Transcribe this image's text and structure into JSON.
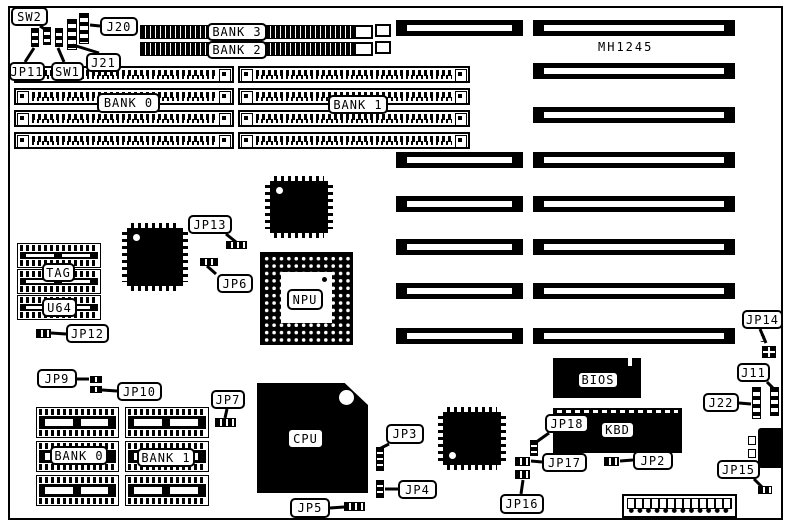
{
  "board": {
    "model": "MH1245",
    "colors": {
      "ink": "#000000",
      "paper": "#ffffff"
    },
    "border": {
      "x": 8,
      "y": 6,
      "w": 775,
      "h": 514
    },
    "callouts": [
      {
        "id": "sw2",
        "label": "SW2",
        "x": 11,
        "y": 7,
        "w": 37,
        "h": 19,
        "leader": [
          [
            40,
            26
          ],
          [
            46,
            30
          ]
        ]
      },
      {
        "id": "j20",
        "label": "J20",
        "x": 100,
        "y": 17,
        "w": 38,
        "h": 19,
        "leader": [
          [
            100,
            26
          ],
          [
            90,
            25
          ]
        ]
      },
      {
        "id": "j21",
        "label": "J21",
        "x": 86,
        "y": 53,
        "w": 35,
        "h": 19,
        "leader": [
          [
            99,
            53
          ],
          [
            73,
            45
          ]
        ]
      },
      {
        "id": "jp11",
        "label": "JP11",
        "x": 9,
        "y": 62,
        "w": 36,
        "h": 19,
        "leader": [
          [
            25,
            62
          ],
          [
            34,
            48
          ]
        ]
      },
      {
        "id": "sw1",
        "label": "SW1",
        "x": 51,
        "y": 62,
        "w": 33,
        "h": 19,
        "leader": [
          [
            64,
            62
          ],
          [
            58,
            48
          ]
        ]
      },
      {
        "id": "bank3",
        "label": "BANK 3",
        "x": 207,
        "y": 23,
        "w": 60,
        "h": 18
      },
      {
        "id": "bank2",
        "label": "BANK 2",
        "x": 207,
        "y": 41,
        "w": 60,
        "h": 18
      },
      {
        "id": "bank0-top",
        "label": "BANK 0",
        "x": 97,
        "y": 93,
        "w": 63,
        "h": 20
      },
      {
        "id": "bank1-top",
        "label": "BANK 1",
        "x": 328,
        "y": 95,
        "w": 60,
        "h": 19
      },
      {
        "id": "jp13",
        "label": "JP13",
        "x": 188,
        "y": 215,
        "w": 44,
        "h": 19,
        "leader": [
          [
            226,
            234
          ],
          [
            236,
            242
          ]
        ]
      },
      {
        "id": "jp6",
        "label": "JP6",
        "x": 217,
        "y": 274,
        "w": 36,
        "h": 19,
        "leader": [
          [
            216,
            274
          ],
          [
            207,
            266
          ]
        ]
      },
      {
        "id": "tag",
        "label": "TAG",
        "x": 42,
        "y": 263,
        "w": 33,
        "h": 19
      },
      {
        "id": "u64",
        "label": "U64",
        "x": 42,
        "y": 298,
        "w": 35,
        "h": 19
      },
      {
        "id": "jp12",
        "label": "JP12",
        "x": 66,
        "y": 324,
        "w": 43,
        "h": 19,
        "leader": [
          [
            66,
            334
          ],
          [
            51,
            333
          ]
        ]
      },
      {
        "id": "jp9",
        "label": "JP9",
        "x": 37,
        "y": 369,
        "w": 40,
        "h": 19,
        "leader": [
          [
            77,
            379
          ],
          [
            89,
            379
          ]
        ]
      },
      {
        "id": "jp10",
        "label": "JP10",
        "x": 117,
        "y": 382,
        "w": 45,
        "h": 19,
        "leader": [
          [
            117,
            391
          ],
          [
            102,
            390
          ]
        ]
      },
      {
        "id": "jp7",
        "label": "JP7",
        "x": 211,
        "y": 390,
        "w": 34,
        "h": 19,
        "leader": [
          [
            227,
            409
          ],
          [
            225,
            418
          ]
        ]
      },
      {
        "id": "bank0-bottom",
        "label": "BANK 0",
        "x": 50,
        "y": 446,
        "w": 58,
        "h": 19
      },
      {
        "id": "bank1-bottom",
        "label": "BANK 1",
        "x": 137,
        "y": 448,
        "w": 58,
        "h": 19
      },
      {
        "id": "cpu",
        "label": "CPU",
        "x": 287,
        "y": 428,
        "w": 37,
        "h": 21
      },
      {
        "id": "npu",
        "label": "NPU",
        "x": 287,
        "y": 289,
        "w": 36,
        "h": 21
      },
      {
        "id": "jp3",
        "label": "JP3",
        "x": 386,
        "y": 424,
        "w": 38,
        "h": 20,
        "leader": [
          [
            389,
            444
          ],
          [
            381,
            448
          ]
        ]
      },
      {
        "id": "jp4",
        "label": "JP4",
        "x": 398,
        "y": 480,
        "w": 39,
        "h": 19,
        "leader": [
          [
            398,
            489
          ],
          [
            385,
            489
          ]
        ]
      },
      {
        "id": "jp5",
        "label": "JP5",
        "x": 290,
        "y": 498,
        "w": 40,
        "h": 20,
        "leader": [
          [
            330,
            508
          ],
          [
            344,
            507
          ]
        ]
      },
      {
        "id": "jp16",
        "label": "JP16",
        "x": 500,
        "y": 494,
        "w": 44,
        "h": 20,
        "leader": [
          [
            521,
            494
          ],
          [
            523,
            480
          ]
        ]
      },
      {
        "id": "jp17",
        "label": "JP17",
        "x": 542,
        "y": 453,
        "w": 45,
        "h": 19,
        "leader": [
          [
            542,
            462
          ],
          [
            531,
            461
          ]
        ]
      },
      {
        "id": "jp18",
        "label": "JP18",
        "x": 545,
        "y": 414,
        "w": 44,
        "h": 19,
        "leader": [
          [
            549,
            433
          ],
          [
            535,
            443
          ]
        ]
      },
      {
        "id": "jp2",
        "label": "JP2",
        "x": 633,
        "y": 451,
        "w": 40,
        "h": 19,
        "leader": [
          [
            633,
            460
          ],
          [
            620,
            461
          ]
        ]
      },
      {
        "id": "bios",
        "label": "BIOS",
        "x": 577,
        "y": 371,
        "w": 42,
        "h": 18
      },
      {
        "id": "kbd",
        "label": "KBD",
        "x": 600,
        "y": 421,
        "w": 35,
        "h": 18
      },
      {
        "id": "jp14",
        "label": "JP14",
        "x": 742,
        "y": 310,
        "w": 41,
        "h": 19,
        "leader": [
          [
            760,
            329
          ],
          [
            766,
            343
          ]
        ]
      },
      {
        "id": "j11",
        "label": "J11",
        "x": 737,
        "y": 363,
        "w": 33,
        "h": 19,
        "leader": [
          [
            767,
            382
          ],
          [
            773,
            388
          ]
        ]
      },
      {
        "id": "j22",
        "label": "J22",
        "x": 703,
        "y": 393,
        "w": 36,
        "h": 19,
        "leader": [
          [
            739,
            403
          ],
          [
            751,
            404
          ]
        ]
      },
      {
        "id": "jp15",
        "label": "JP15",
        "x": 717,
        "y": 460,
        "w": 43,
        "h": 19,
        "leader": [
          [
            754,
            479
          ],
          [
            762,
            487
          ]
        ]
      },
      {
        "id": "model",
        "label": "MH1245",
        "x": 598,
        "y": 40,
        "w": 74,
        "h": 14,
        "plain": true
      },
      {
        "id": "jp14-pin3",
        "label": "3",
        "x": 760,
        "y": 333,
        "w": 12,
        "h": 12,
        "plain": true,
        "fs": 10
      }
    ],
    "isa_slots": {
      "left": {
        "x": 396,
        "w": 127,
        "h": 16,
        "ys": [
          20,
          152,
          196,
          239,
          283,
          328
        ]
      },
      "right": {
        "x": 533,
        "w": 202,
        "h": 16,
        "ys": [
          20,
          63,
          107,
          152,
          196,
          239,
          283,
          328
        ]
      }
    },
    "simm_banks_30pin": {
      "bars": [
        {
          "x": 140,
          "y": 25,
          "w": 214,
          "h": 14
        },
        {
          "x": 140,
          "y": 42,
          "w": 214,
          "h": 14
        }
      ],
      "latches": [
        {
          "x": 354,
          "y": 25,
          "w": 19,
          "h": 14
        },
        {
          "x": 354,
          "y": 42,
          "w": 19,
          "h": 14
        }
      ],
      "ends": [
        {
          "x": 375,
          "y": 24,
          "w": 16,
          "h": 13
        },
        {
          "x": 375,
          "y": 41,
          "w": 16,
          "h": 13
        }
      ]
    },
    "simm_rows": {
      "h": 17,
      "ys": [
        66,
        88,
        110,
        132
      ],
      "groups": [
        {
          "x": 14,
          "w": 220
        },
        {
          "x": 238,
          "w": 232
        }
      ]
    },
    "dip_groups": [
      {
        "name": "cache-sram",
        "x": 17,
        "w": 84,
        "ys": [
          243,
          269,
          295
        ],
        "h": 25
      },
      {
        "name": "dram-bank0",
        "x": 36,
        "w": 83,
        "ys": [
          407,
          441,
          475
        ],
        "h": 31
      },
      {
        "name": "dram-bank1",
        "x": 125,
        "w": 84,
        "ys": [
          407,
          441,
          475
        ],
        "h": 31
      }
    ],
    "qfp_chips": [
      {
        "id": "qfp-chipset-1",
        "x": 122,
        "y": 223,
        "w": 66,
        "h": 68,
        "dot": "tl"
      },
      {
        "id": "qfp-chipset-2",
        "x": 265,
        "y": 176,
        "w": 68,
        "h": 62,
        "dot": "tl"
      },
      {
        "id": "qfp-chipset-3",
        "x": 438,
        "y": 407,
        "w": 68,
        "h": 63,
        "dot": "bl"
      }
    ],
    "npu_socket": {
      "x": 260,
      "y": 252,
      "w": 93,
      "h": 93,
      "win": {
        "x": 21,
        "y": 20,
        "w": 51,
        "h": 51
      }
    },
    "cpu_chip": {
      "x": 257,
      "y": 383,
      "w": 111,
      "h": 110
    },
    "bios_chip": {
      "x": 553,
      "y": 358,
      "w": 88,
      "h": 40
    },
    "kbd_chip": {
      "x": 553,
      "y": 408,
      "w": 129,
      "h": 45
    },
    "vheaders": [
      {
        "id": "j21-header",
        "x": 67,
        "y": 19,
        "w": 10,
        "h": 31
      },
      {
        "id": "j20-header",
        "x": 79,
        "y": 13,
        "w": 10,
        "h": 31
      },
      {
        "id": "j22-header",
        "x": 752,
        "y": 387,
        "w": 9,
        "h": 32
      },
      {
        "id": "j11-header",
        "x": 770,
        "y": 387,
        "w": 9,
        "h": 29
      }
    ],
    "sw_blocks": [
      {
        "id": "jp11-block",
        "x": 31,
        "y": 28,
        "w": 8,
        "h": 19
      },
      {
        "id": "sw2-block",
        "x": 43,
        "y": 27,
        "w": 8,
        "h": 18
      },
      {
        "id": "sw1-block",
        "x": 55,
        "y": 28,
        "w": 8,
        "h": 19
      }
    ],
    "jumpers": [
      {
        "id": "jp13-jumper",
        "x": 226,
        "y": 241,
        "w": 21,
        "h": 8,
        "o": "h"
      },
      {
        "id": "jp6-jumper",
        "x": 200,
        "y": 258,
        "w": 18,
        "h": 8,
        "o": "h"
      },
      {
        "id": "jp12-jumper",
        "x": 36,
        "y": 329,
        "w": 15,
        "h": 9,
        "o": "h"
      },
      {
        "id": "jp9-jumper",
        "x": 90,
        "y": 376,
        "w": 12,
        "h": 7,
        "o": "h"
      },
      {
        "id": "jp10-jumper",
        "x": 90,
        "y": 386,
        "w": 12,
        "h": 7,
        "o": "h"
      },
      {
        "id": "jp7-jumper",
        "x": 215,
        "y": 418,
        "w": 21,
        "h": 9,
        "o": "h"
      },
      {
        "id": "jp3-jumper",
        "x": 376,
        "y": 447,
        "w": 8,
        "h": 24,
        "o": "v"
      },
      {
        "id": "jp4-jumper",
        "x": 376,
        "y": 480,
        "w": 8,
        "h": 18,
        "o": "v"
      },
      {
        "id": "jp5-jumper",
        "x": 344,
        "y": 502,
        "w": 21,
        "h": 9,
        "o": "h"
      },
      {
        "id": "jp17-jumper",
        "x": 515,
        "y": 457,
        "w": 15,
        "h": 9,
        "o": "h"
      },
      {
        "id": "jp16-jumper",
        "x": 515,
        "y": 470,
        "w": 15,
        "h": 9,
        "o": "h"
      },
      {
        "id": "jp18-jumper",
        "x": 530,
        "y": 440,
        "w": 8,
        "h": 16,
        "o": "v"
      },
      {
        "id": "jp2-jumper",
        "x": 604,
        "y": 457,
        "w": 15,
        "h": 9,
        "o": "h"
      },
      {
        "id": "jp15-jumper",
        "x": 758,
        "y": 486,
        "w": 14,
        "h": 8,
        "o": "h"
      }
    ],
    "jp14_pin_block": {
      "x": 762,
      "y": 346,
      "w": 14,
      "h": 12
    },
    "kb_connector": {
      "x": 758,
      "y": 428,
      "w": 25,
      "h": 40,
      "pins": [
        {
          "x": 748,
          "y": 436,
          "w": 8,
          "h": 9
        },
        {
          "x": 748,
          "y": 449,
          "w": 8,
          "h": 9
        }
      ]
    },
    "power_connector": {
      "x": 622,
      "y": 494,
      "w": 115,
      "h": 24
    }
  }
}
